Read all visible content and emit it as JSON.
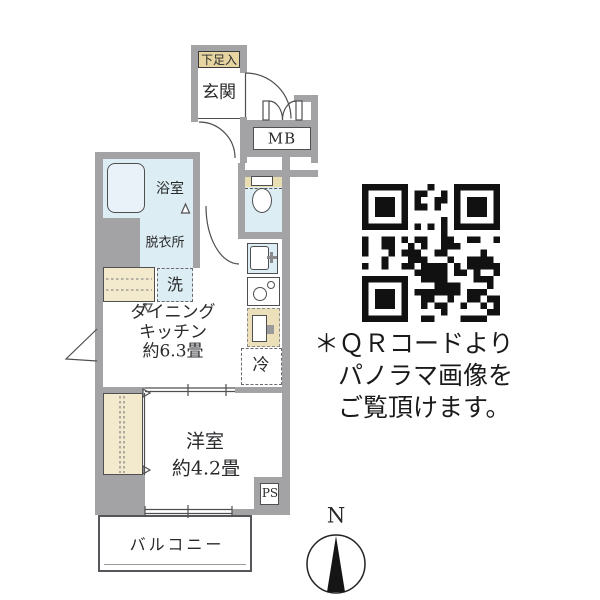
{
  "floor_plan": {
    "labels": {
      "shoe_cabinet": "下足入",
      "entrance": "玄関",
      "meter_box": "MB",
      "bathroom": "浴室",
      "dressing_room": "脱衣所",
      "washing_machine": "洗",
      "refrigerator": "冷",
      "dining_kitchen": [
        "ダイニング",
        "キッチン",
        "約6.3畳"
      ],
      "western_room": [
        "洋室",
        "約4.2畳"
      ],
      "pipe_space": "PS",
      "balcony": "バルコニー"
    }
  },
  "qr_note": {
    "lines": [
      "＊ＱＲコードより",
      "パノラマ画像を",
      "ご覧頂けます。"
    ]
  },
  "compass": {
    "north_label": "N"
  },
  "colors": {
    "wall_gray": "#a3a3a5",
    "water_blue": "#dcedf4",
    "tan": "#e6d5a0",
    "cream": "#f3e9cd",
    "counter_beige": "#ece0ba",
    "outline": "#4f4f52",
    "qr_black": "#111111"
  }
}
